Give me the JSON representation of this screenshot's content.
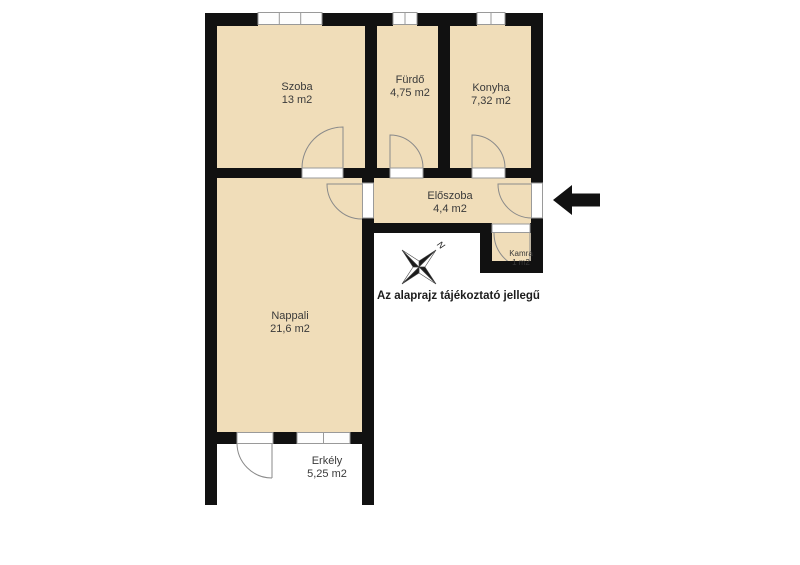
{
  "plan": {
    "rooms": [
      {
        "name": "Szoba",
        "area": "13 m2"
      },
      {
        "name": "Fürdő",
        "area": "4,75 m2"
      },
      {
        "name": "Konyha",
        "area": "7,32 m2"
      },
      {
        "name": "Előszoba",
        "area": "4,4 m2"
      },
      {
        "name": "Kamra",
        "area": "1 m2"
      },
      {
        "name": "Nappali",
        "area": "21,6 m2"
      },
      {
        "name": "Erkély",
        "area": "5,25 m2"
      }
    ],
    "note": "Az alaprajz tájékoztató jellegű",
    "compass_label": "N",
    "colors": {
      "wall": "#111111",
      "floor": "#f0ddb9",
      "window_border": "#999999",
      "door_arc": "#8a8a8a",
      "label_text": "#3a3a3a",
      "arrow": "#111111"
    }
  }
}
